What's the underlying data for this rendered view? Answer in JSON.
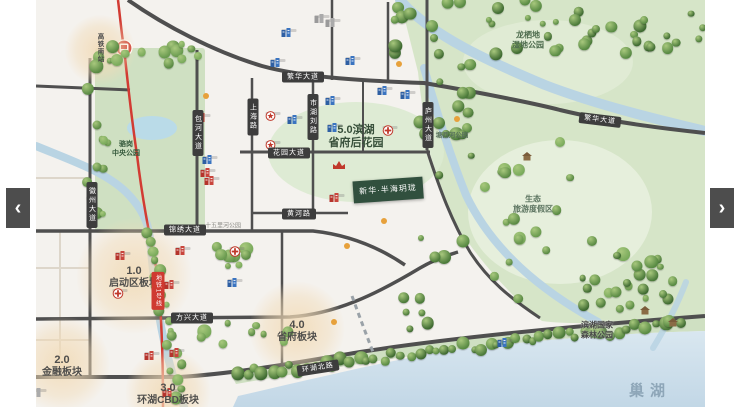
{
  "nav": {
    "prev": "‹",
    "next": "›"
  },
  "transit": {
    "station": "高铁南站",
    "line": "地铁1号线"
  },
  "roads": [
    {
      "id": "fanhua-1",
      "label": "繁华大道"
    },
    {
      "id": "fanhua-2",
      "label": "繁华大道"
    },
    {
      "id": "huayuan",
      "label": "花园大道"
    },
    {
      "id": "huanghe",
      "label": "黄河路"
    },
    {
      "id": "jinxiu",
      "label": "锦绣大道"
    },
    {
      "id": "fangxing",
      "label": "方兴大道"
    },
    {
      "id": "huanhu",
      "label": "环湖北路"
    },
    {
      "id": "huizhou",
      "label": "徽州大道"
    },
    {
      "id": "baohe",
      "label": "包河大道"
    },
    {
      "id": "shanghai",
      "label": "上海路"
    },
    {
      "id": "shihu",
      "label": "市湖刘路"
    },
    {
      "id": "luzhou",
      "label": "庐州大道"
    }
  ],
  "zones": [
    {
      "num": "1.0",
      "name": "启动区板块"
    },
    {
      "num": "2.0",
      "name": "金融板块"
    },
    {
      "num": "3.0",
      "name": "环湖CBD板块"
    },
    {
      "num": "4.0",
      "name": "省府板块"
    }
  ],
  "zone5": {
    "line1": "5.0滨湖",
    "line2": "省府后花园"
  },
  "parks": {
    "central": {
      "line1": "骆岗",
      "line2": "中央公园"
    },
    "longqidi": {
      "line1": "龙栖地",
      "line2": "湿地公园"
    },
    "tangxihe": {
      "name": "塘西河公园"
    },
    "shengtai": {
      "line1": "生态",
      "line2": "旅游度假区"
    },
    "forest": {
      "line1": "滨湖国家",
      "line2": "森林公园"
    },
    "shiwuli": {
      "name": "十五里河公园"
    },
    "lake": {
      "name": "巢湖"
    }
  },
  "project": {
    "name": "新华·半海玥珑"
  }
}
